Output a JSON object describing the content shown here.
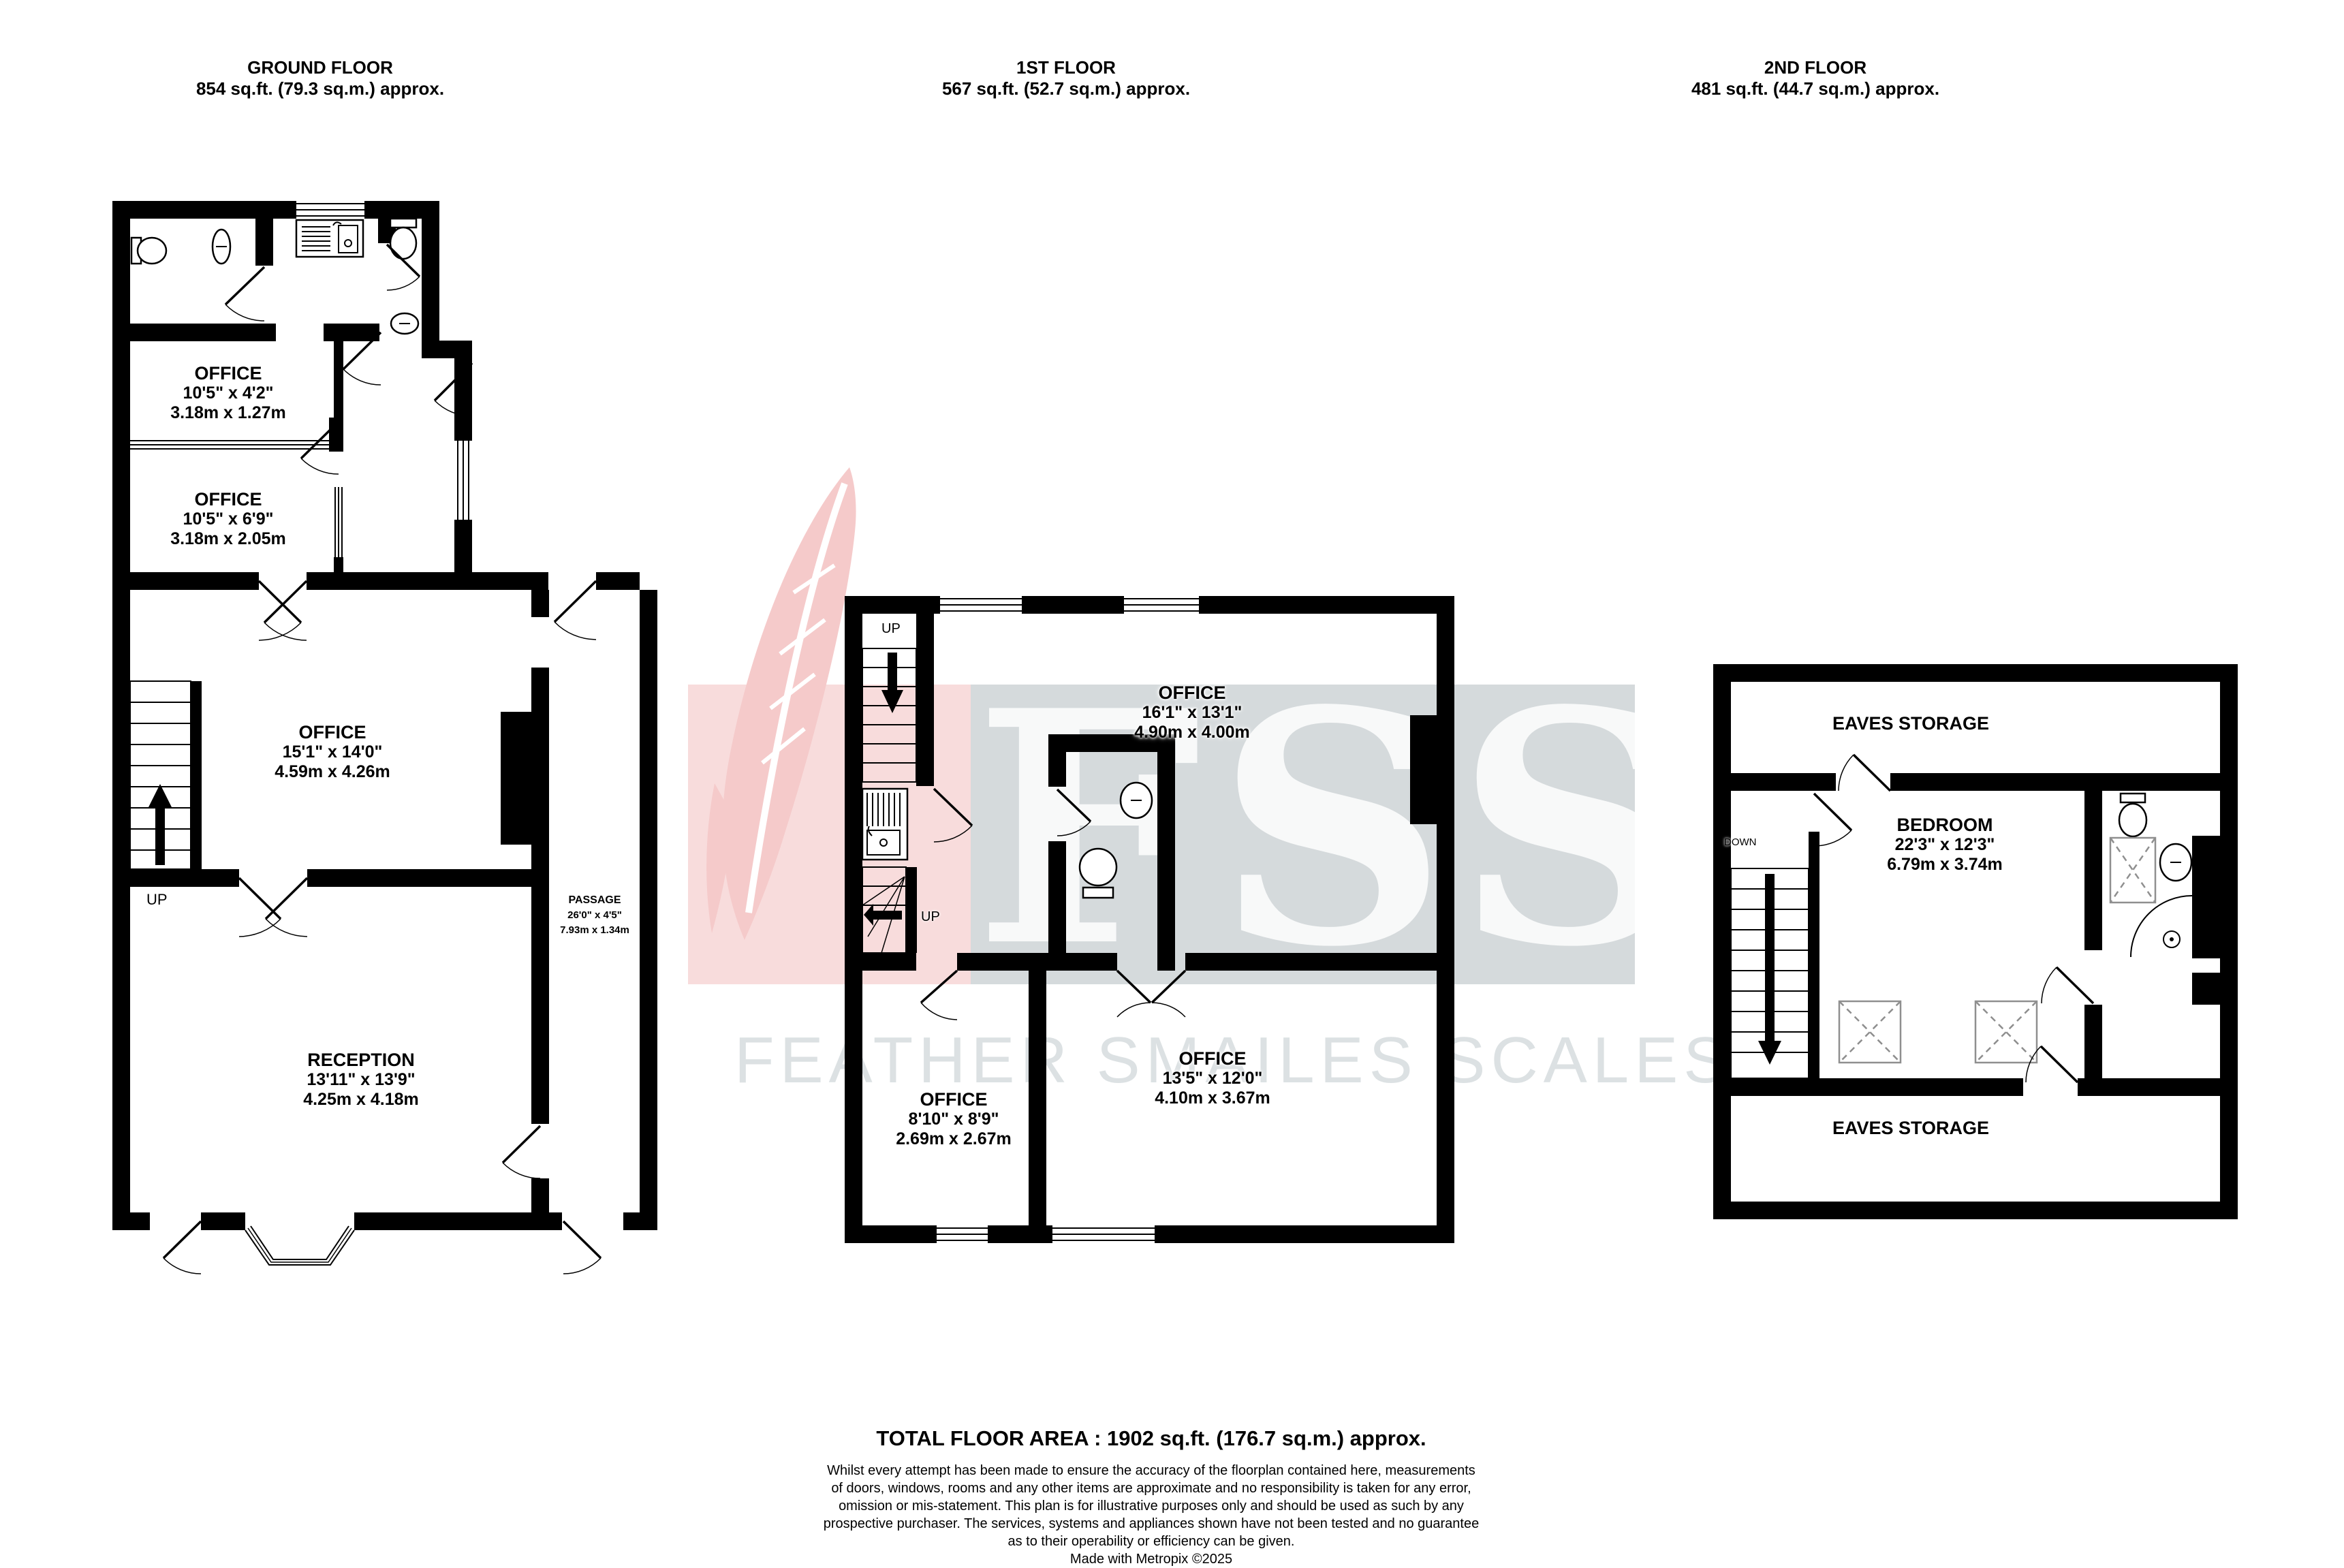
{
  "floors": {
    "ground": {
      "title": "GROUND FLOOR",
      "area": "854 sq.ft. (79.3 sq.m.) approx."
    },
    "first": {
      "title": "1ST FLOOR",
      "area": "567 sq.ft. (52.7 sq.m.) approx."
    },
    "second": {
      "title": "2ND FLOOR",
      "area": "481 sq.ft. (44.7 sq.m.) approx."
    }
  },
  "rooms": {
    "g_office_small": {
      "name": "OFFICE",
      "imperial": "10'5\" x 4'2\"",
      "metric": "3.18m x 1.27m"
    },
    "g_office_mid": {
      "name": "OFFICE",
      "imperial": "10'5\" x 6'9\"",
      "metric": "3.18m x 2.05m"
    },
    "g_office_main": {
      "name": "OFFICE",
      "imperial": "15'1\" x 14'0\"",
      "metric": "4.59m x 4.26m"
    },
    "g_passage": {
      "name": "PASSAGE",
      "imperial": "26'0\" x 4'5\"",
      "metric": "7.93m x 1.34m"
    },
    "g_reception": {
      "name": "RECEPTION",
      "imperial": "13'11\" x 13'9\"",
      "metric": "4.25m x 4.18m"
    },
    "f_office_large": {
      "name": "OFFICE",
      "imperial": "16'1\" x 13'1\"",
      "metric": "4.90m x 4.00m"
    },
    "f_office_small": {
      "name": "OFFICE",
      "imperial": "8'10\" x 8'9\"",
      "metric": "2.69m x 2.67m"
    },
    "f_office_mid": {
      "name": "OFFICE",
      "imperial": "13'5\" x 12'0\"",
      "metric": "4.10m x 3.67m"
    },
    "s_eaves_top": {
      "name": "EAVES STORAGE"
    },
    "s_bedroom": {
      "name": "BEDROOM",
      "imperial": "22'3\" x 12'3\"",
      "metric": "6.79m x 3.74m"
    },
    "s_eaves_bottom": {
      "name": "EAVES STORAGE"
    }
  },
  "stair_labels": {
    "up": "UP",
    "down": "DOWN"
  },
  "watermark": {
    "initials": "FSS",
    "name": "FEATHER SMAILES SCALES"
  },
  "footer": {
    "total": "TOTAL FLOOR AREA : 1902 sq.ft. (176.7 sq.m.) approx.",
    "lines": [
      "Whilst every attempt has been made to ensure the accuracy of the floorplan contained here, measurements",
      "of doors, windows, rooms and any other items are approximate and no responsibility is taken for any error,",
      "omission or mis-statement. This plan is for illustrative purposes only and should be used as such by any",
      "prospective purchaser. The services, systems and appliances shown have not been tested and no guarantee",
      "as to their operability or efficiency can be given.",
      "Made with Metropix ©2025"
    ]
  }
}
